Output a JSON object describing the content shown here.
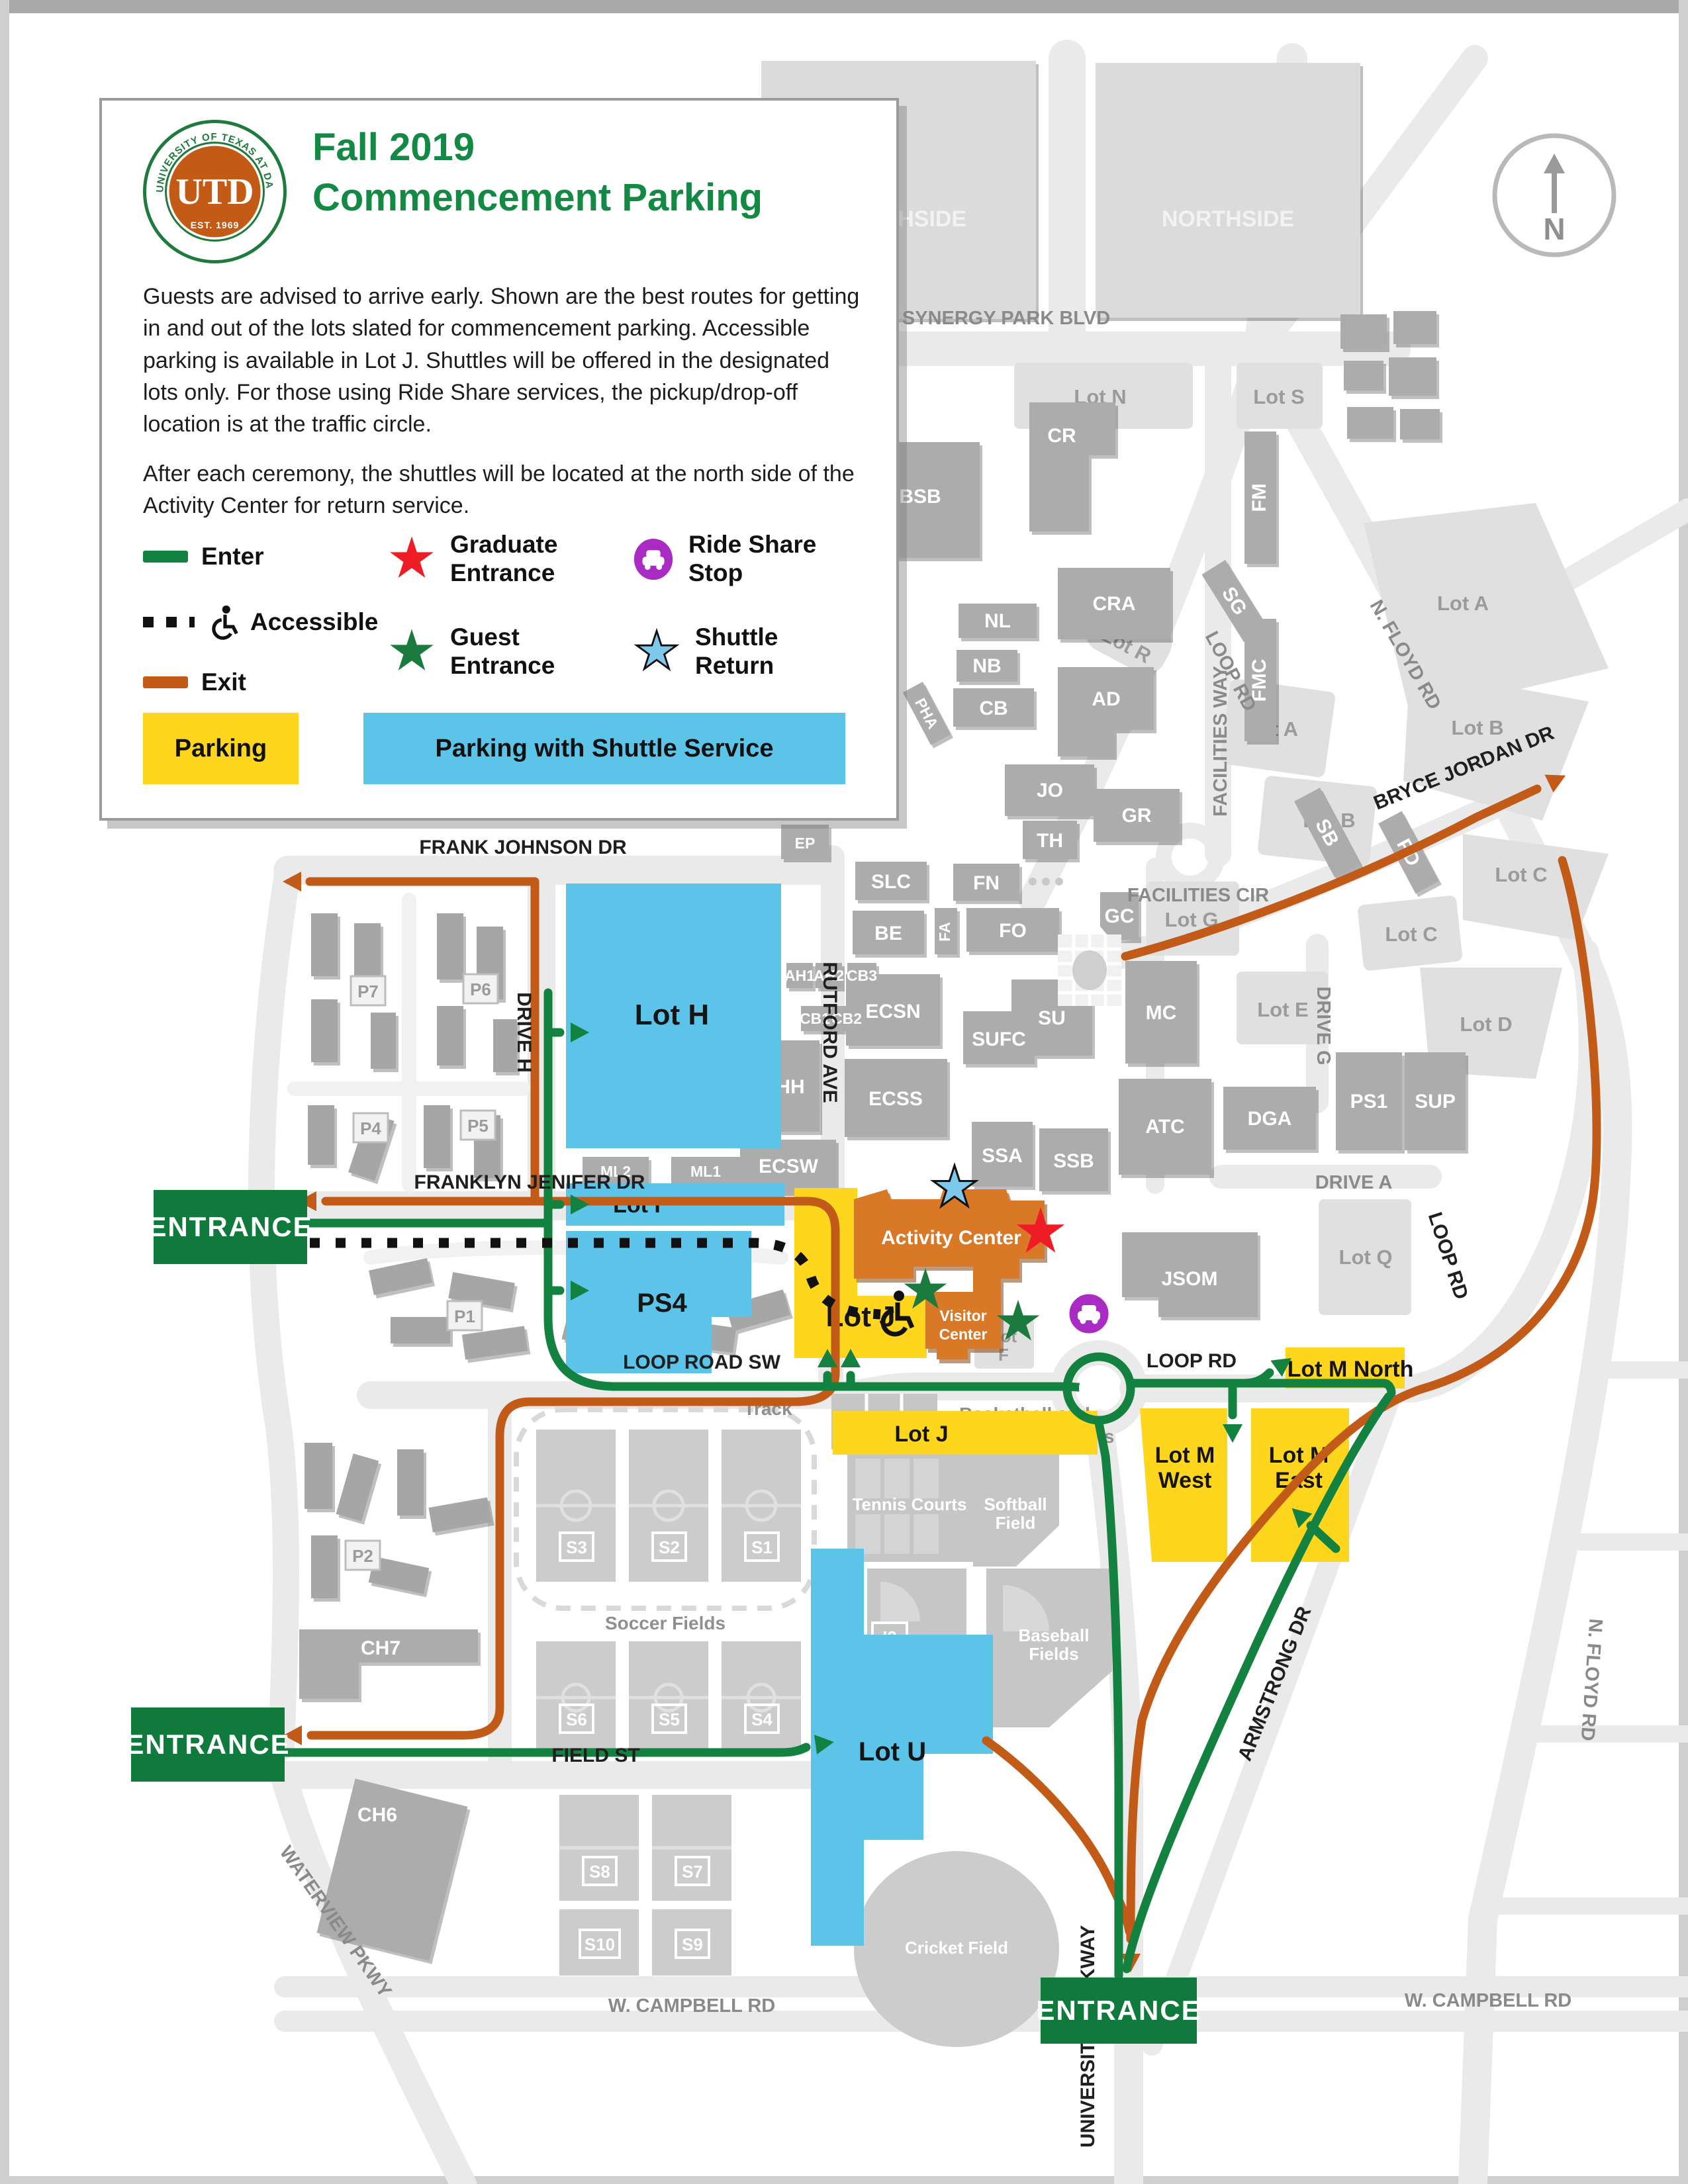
{
  "legend": {
    "title_line1": "Fall 2019",
    "title_line2": "Commencement Parking",
    "intro": "Guests are advised to arrive early. Shown are the best routes for getting in and out of the lots slated for commencement parking. Accessible parking is available in Lot J. Shuttles will be offered in the designated lots only. For those using Ride Share services, the pickup/drop-off location is at the traffic circle.",
    "shuttle_note": "After each ceremony, the shuttles will be located at the north side of the Activity Center for return service.",
    "enter": "Enter",
    "accessible": "Accessible",
    "exit": "Exit",
    "graduate_entrance_1": "Graduate",
    "graduate_entrance_2": "Entrance",
    "guest_entrance_1": "Guest",
    "guest_entrance_2": "Entrance",
    "ride_share_1": "Ride Share",
    "ride_share_2": "Stop",
    "shuttle_return_1": "Shuttle",
    "shuttle_return_2": "Return",
    "parking": "Parking",
    "parking_shuttle": "Parking with Shuttle Service",
    "seal_top": "THE UNIVERSITY OF TEXAS AT DALLAS",
    "seal_bottom": "EST. 1969",
    "seal_monogram": "UTD"
  },
  "compass": {
    "n": "N"
  },
  "labels": {
    "entrance": "ENTRANCE",
    "synergy_park_blvd": "SYNERGY PARK BLVD",
    "facilities_way": "FACILITIES WAY",
    "facilities_cir": "FACILITIES CIR",
    "n_floyd_rd": "N. FLOYD RD",
    "loop_rd": "LOOP RD",
    "loop_road_sw": "LOOP ROAD SW",
    "bryce_jordan_dr": "BRYCE JORDAN DR",
    "frank_johnson_dr": "FRANK JOHNSON DR",
    "drive_h": "DRIVE H",
    "rutford_ave": "RUTFORD AVE",
    "franklyn_jenifer_dr": "FRANKLYN JENIFER DR",
    "drive_g": "DRIVE G",
    "drive_a": "DRIVE A",
    "field_st": "FIELD ST",
    "waterview_pkwy": "WATERVIEW PKWY",
    "university_parkway": "UNIVERSITY PARKWAY",
    "armstrong_dr": "ARMSTRONG DR",
    "w_campbell_rd": "W. CAMPBELL RD",
    "northside": "NORTHSIDE",
    "cr": "CR",
    "cra": "CRA",
    "bsb": "BSB",
    "fm": "FM",
    "fmc": "FMC",
    "sb": "SB",
    "pd": "PD",
    "sg": "SG",
    "nl": "NL",
    "nb": "NB",
    "cb": "CB",
    "pha": "PHA",
    "ad": "AD",
    "jo": "JO",
    "gr": "GR",
    "th": "TH",
    "ep": "EP",
    "slc": "SLC",
    "fn": "FN",
    "be": "BE",
    "fa": "FA",
    "fo": "FO",
    "gc": "GC",
    "ecsn": "ECSN",
    "su": "SU",
    "sufc": "SUFC",
    "mc": "MC",
    "ecss": "ECSS",
    "ssa": "SSA",
    "ssb": "SSB",
    "atc": "ATC",
    "dga": "DGA",
    "ps1": "PS1",
    "sup": "SUP",
    "jsom": "JSOM",
    "hh": "HH",
    "ah1": "AH1",
    "ah2": "AH2",
    "cb3": "CB3",
    "cb1": "CB1",
    "cb2": "CB2",
    "ml2": "ML2",
    "ml1": "ML1",
    "ecsw": "ECSW",
    "ch7": "CH7",
    "ch6": "CH6",
    "i2": "I2",
    "lot_n": "Lot N",
    "lot_s": "Lot S",
    "lot_a": "Lot A",
    "lot_b": "Lot B",
    "lot_c": "Lot C",
    "lot_r": "Lot R",
    "lot_g": "Lot G",
    "lot_e": "Lot E",
    "lot_d": "Lot D",
    "lot_q": "Lot Q",
    "lot_f_line1": "Lot",
    "lot_f_line2": "F",
    "lot_h": "Lot H",
    "lot_i": "Lot I",
    "ps4": "PS4",
    "lot_u": "Lot U",
    "lot_j": "Lot J",
    "lot_m_north": "Lot M North",
    "lot_m_line1": "Lot M",
    "lot_m_west": "West",
    "lot_m_east": "East",
    "track": "Track",
    "soccer_fields": "Soccer Fields",
    "tennis_courts": "Tennis Courts",
    "softball_line1": "Softball",
    "softball_line2": "Field",
    "baseball_line1": "Baseball",
    "baseball_line2": "Fields",
    "basketball_line1": "Basketball and",
    "basketball_line2": "Volleyball Courts",
    "cricket_field": "Cricket Field",
    "p1": "P1",
    "p2": "P2",
    "p3": "P3",
    "p4": "P4",
    "p5": "P5",
    "p6": "P6",
    "p7": "P7",
    "s1": "S1",
    "s2": "S2",
    "s3": "S3",
    "s4": "S4",
    "s5": "S5",
    "s6": "S6",
    "s7": "S7",
    "s8": "S8",
    "s9": "S9",
    "s10": "S10",
    "activity_center": "Activity Center",
    "visitor_center_line1": "Visitor",
    "visitor_center_line2": "Center"
  }
}
